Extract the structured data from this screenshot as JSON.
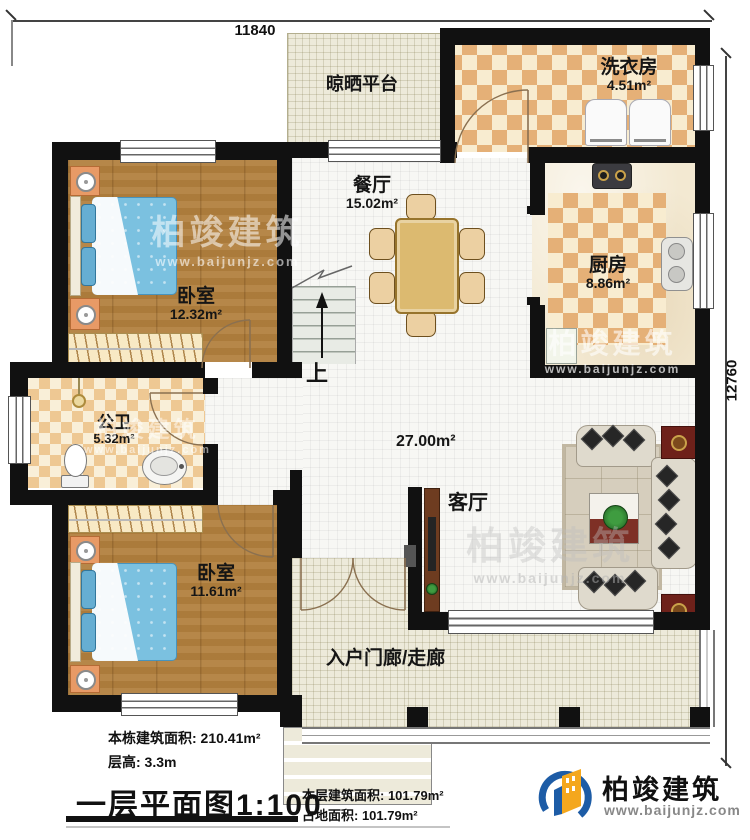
{
  "dimensions": {
    "top": "11840",
    "right": "12760"
  },
  "rooms": {
    "drying_platform": {
      "name": "晾晒平台"
    },
    "laundry": {
      "name": "洗衣房",
      "area": "4.51m²"
    },
    "dining": {
      "name": "餐厅",
      "area": "15.02m²"
    },
    "kitchen": {
      "name": "厨房",
      "area": "8.86m²"
    },
    "bedroom_top": {
      "name": "卧室",
      "area": "12.32m²"
    },
    "bathroom": {
      "name": "公卫",
      "area": "5.32m²"
    },
    "bedroom_bottom": {
      "name": "卧室",
      "area": "11.61m²"
    },
    "living": {
      "name": "客厅",
      "area": "27.00m²"
    },
    "porch": {
      "name": "入户门廊/走廊"
    },
    "stairs": {
      "up": "上"
    }
  },
  "notes": {
    "building_area": "本栋建筑面积: 210.41m²",
    "floor_height": "层高: 3.3m"
  },
  "footer": {
    "title": "一层平面图",
    "scale": "1:100",
    "floor_area": "本层建筑面积: 101.79m²",
    "footprint": "占地面积: 101.79m²"
  },
  "brand": {
    "name": "柏竣建筑",
    "website": "www.baijunjz.com"
  },
  "watermark": {
    "name": "柏竣建筑",
    "website": "www.baijunjz.com"
  },
  "colors": {
    "wall": "#111111",
    "wood": "#b2813f",
    "tile_dark": "#e5b077",
    "tile_light": "#f8ecd0",
    "outdoor": "#edeada",
    "bed": "#7bc1e0",
    "brand_blue": "#1d5ca6",
    "brand_orange": "#f4a71d"
  }
}
